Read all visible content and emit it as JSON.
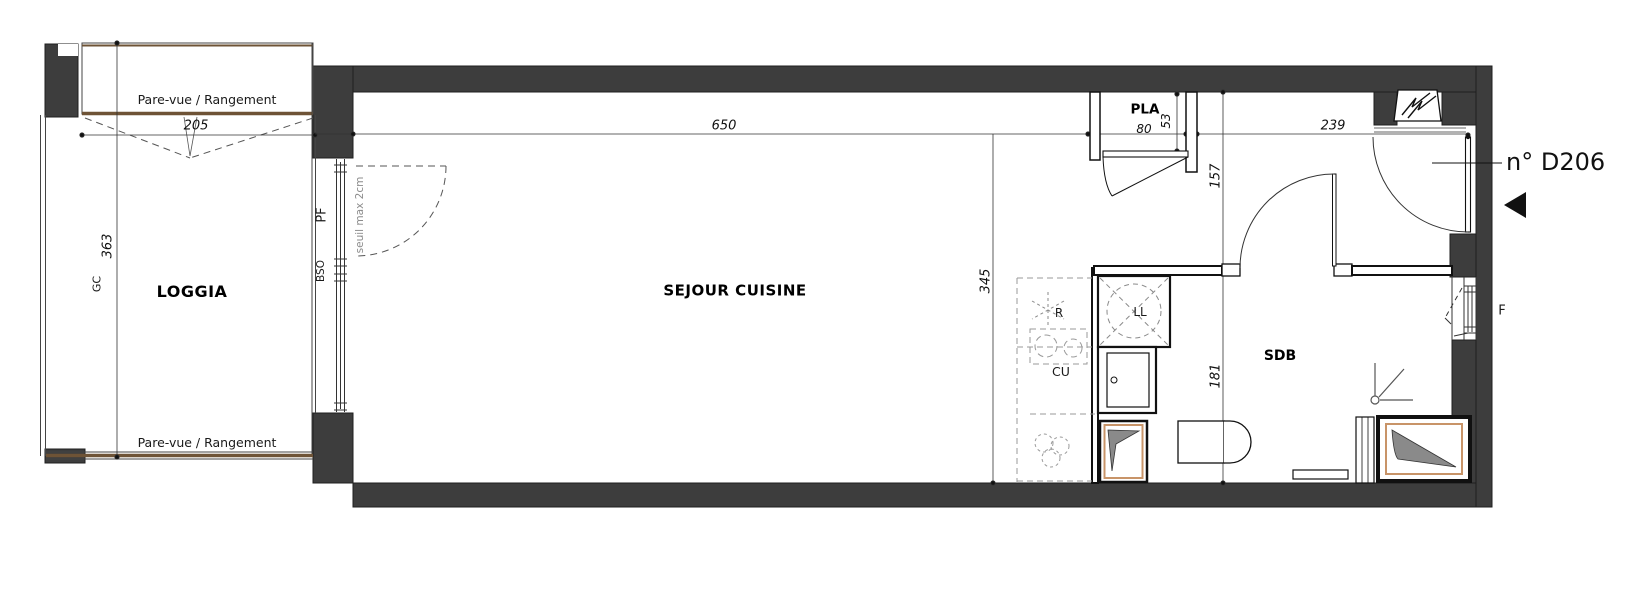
{
  "plan": {
    "unit_label": "n° D206",
    "rooms": {
      "loggia": "LOGGIA",
      "sejour": "SEJOUR CUISINE",
      "pla": "PLA",
      "sdb": "SDB"
    },
    "labels": {
      "pare_vue_top": "Pare-vue / Rangement",
      "pare_vue_bottom": "Pare-vue / Rangement",
      "gc": "GC",
      "pf": "PF",
      "bso": "BSO",
      "seuil": "seuil max 2cm",
      "window_f": "F",
      "fridge": "R",
      "cooktop": "CU",
      "washer": "LL"
    },
    "dimensions": {
      "loggia_width": "205",
      "loggia_depth": "363",
      "sejour_width": "650",
      "sejour_depth": "345",
      "pla_width": "80",
      "pla_depth": "53",
      "entry_depth": "157",
      "sdb_depth": "181",
      "entry_width": "239"
    },
    "colors": {
      "wall": "#3d3d3d",
      "wood_trim": "#6e5336",
      "duct_accent": "#c89468",
      "muted_text": "#8c8c8c"
    }
  }
}
